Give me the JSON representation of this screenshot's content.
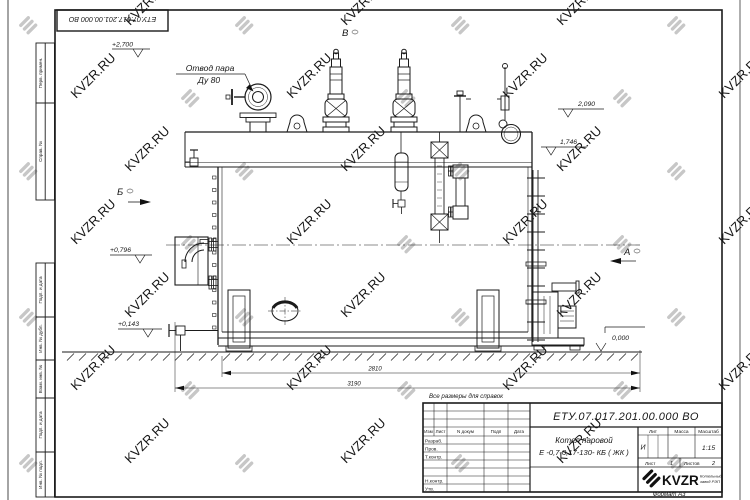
{
  "watermark": {
    "text": "KVZR.RU",
    "color": "#c7c7c7"
  },
  "corner_stamp": {
    "doc_number": "ЕТУ.07.017.201.00.000  ВО"
  },
  "margin_labels": [
    "Перв. примен.",
    "Справ. №",
    "Подп. и дата",
    "Инв. № дубл.",
    "Взам. инв. №",
    "Подп. и дата",
    "Инв. № подл."
  ],
  "drawing": {
    "callout_steam_outlet": {
      "line1": "Отвод пара",
      "line2": "Ду 80"
    },
    "view_labels": {
      "b": "Б",
      "v": "В",
      "a": "А"
    },
    "elevations": {
      "plus2700": "+2,700",
      "v2090": "2,090",
      "v1746": "1,746",
      "plus0796": "+0,796",
      "plus0143": "+0,143",
      "zero": "0,000"
    },
    "dimensions": {
      "d2810": "2810",
      "d3190": "3190"
    },
    "note": "Все размеры для справок"
  },
  "title_block": {
    "doc_number": "ЕТУ.07.017.201.00.000  ВО",
    "product_line1": "Котел паровой",
    "product_line2": "Е -0,7-0,17-130- КБ ( ЖК )",
    "col_izm": "Изм",
    "col_list": "Лист",
    "col_ndokum": "N докум",
    "col_podp": "Подп",
    "col_data": "Дата",
    "row_razrab": "Разраб.",
    "row_prov": "Пров.",
    "row_tkontr": "Т.контр.",
    "row_nkontr": "Н.контр.",
    "row_utv": "Утв.",
    "lit_label": "Лит",
    "lit_value": "И",
    "massa_label": "Масса",
    "scale_label": "Масштаб",
    "scale_value": "1:15",
    "sheet_label": "Лист",
    "sheet_value": "1",
    "sheets_label": "Листов",
    "sheets_value": "2",
    "logo_text": "KVZR",
    "logo_sub1": "Котельный",
    "logo_sub2": "завод РЭП",
    "format_note": "Формат А3"
  }
}
